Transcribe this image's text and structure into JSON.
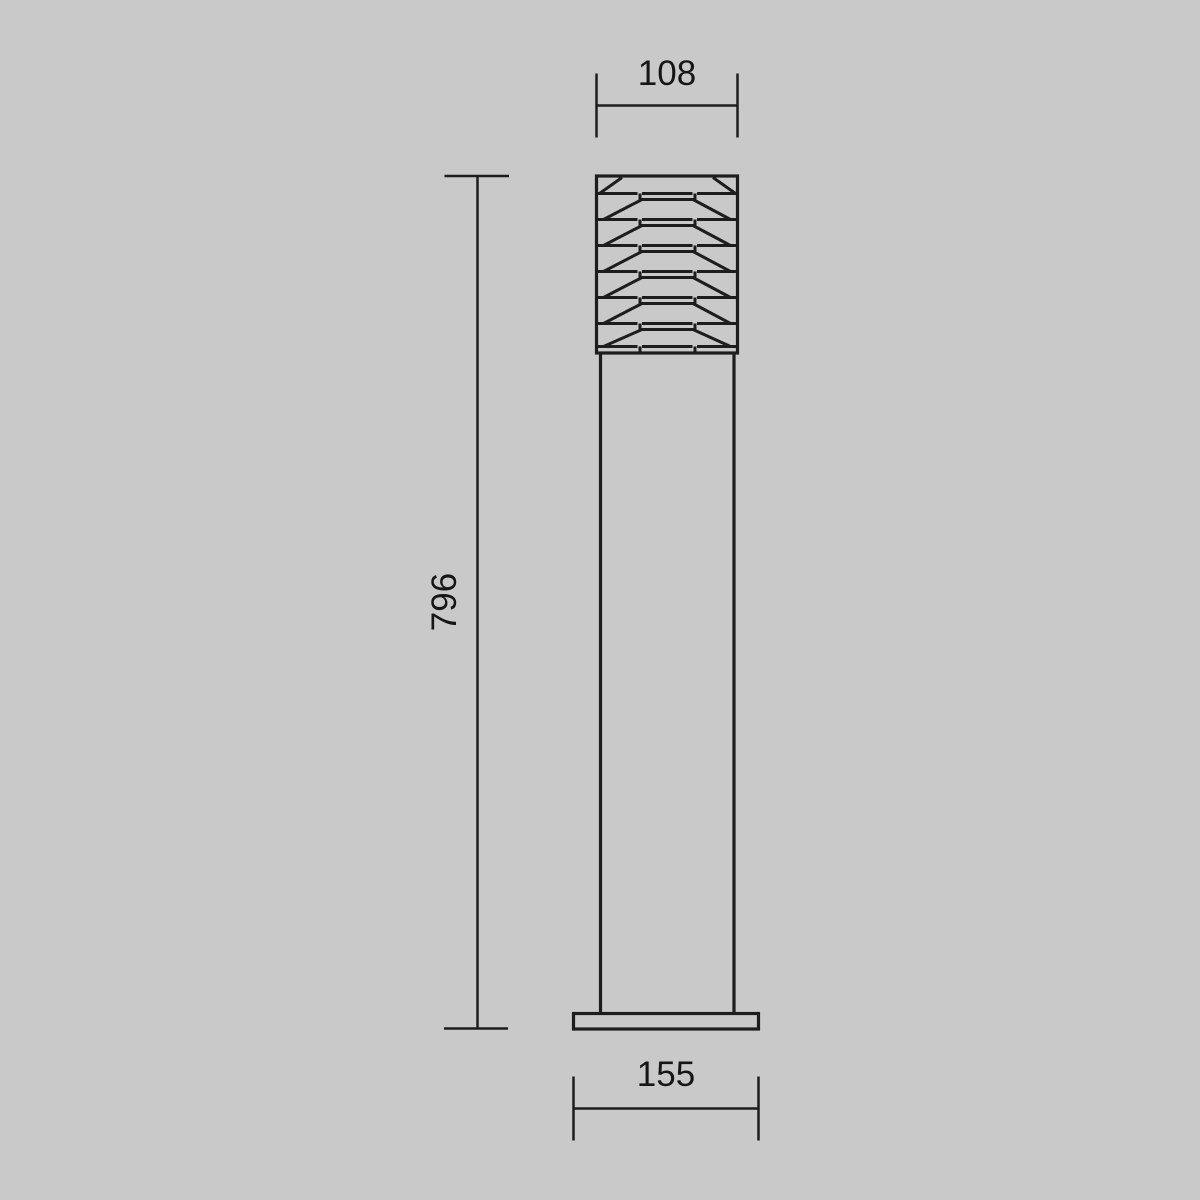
{
  "colors": {
    "background": "#c9c9c9",
    "line": "#1d1d1d",
    "text": "#161616"
  },
  "drawing": {
    "kind": "technical dimension drawing",
    "subject": "bollard floor luminaire, front elevation",
    "louver_slat_count": 7,
    "dimensions": {
      "head_width": {
        "value": "108",
        "position": "top"
      },
      "overall_height": {
        "value": "796",
        "position": "left"
      },
      "base_width": {
        "value": "155",
        "position": "bottom"
      }
    }
  }
}
